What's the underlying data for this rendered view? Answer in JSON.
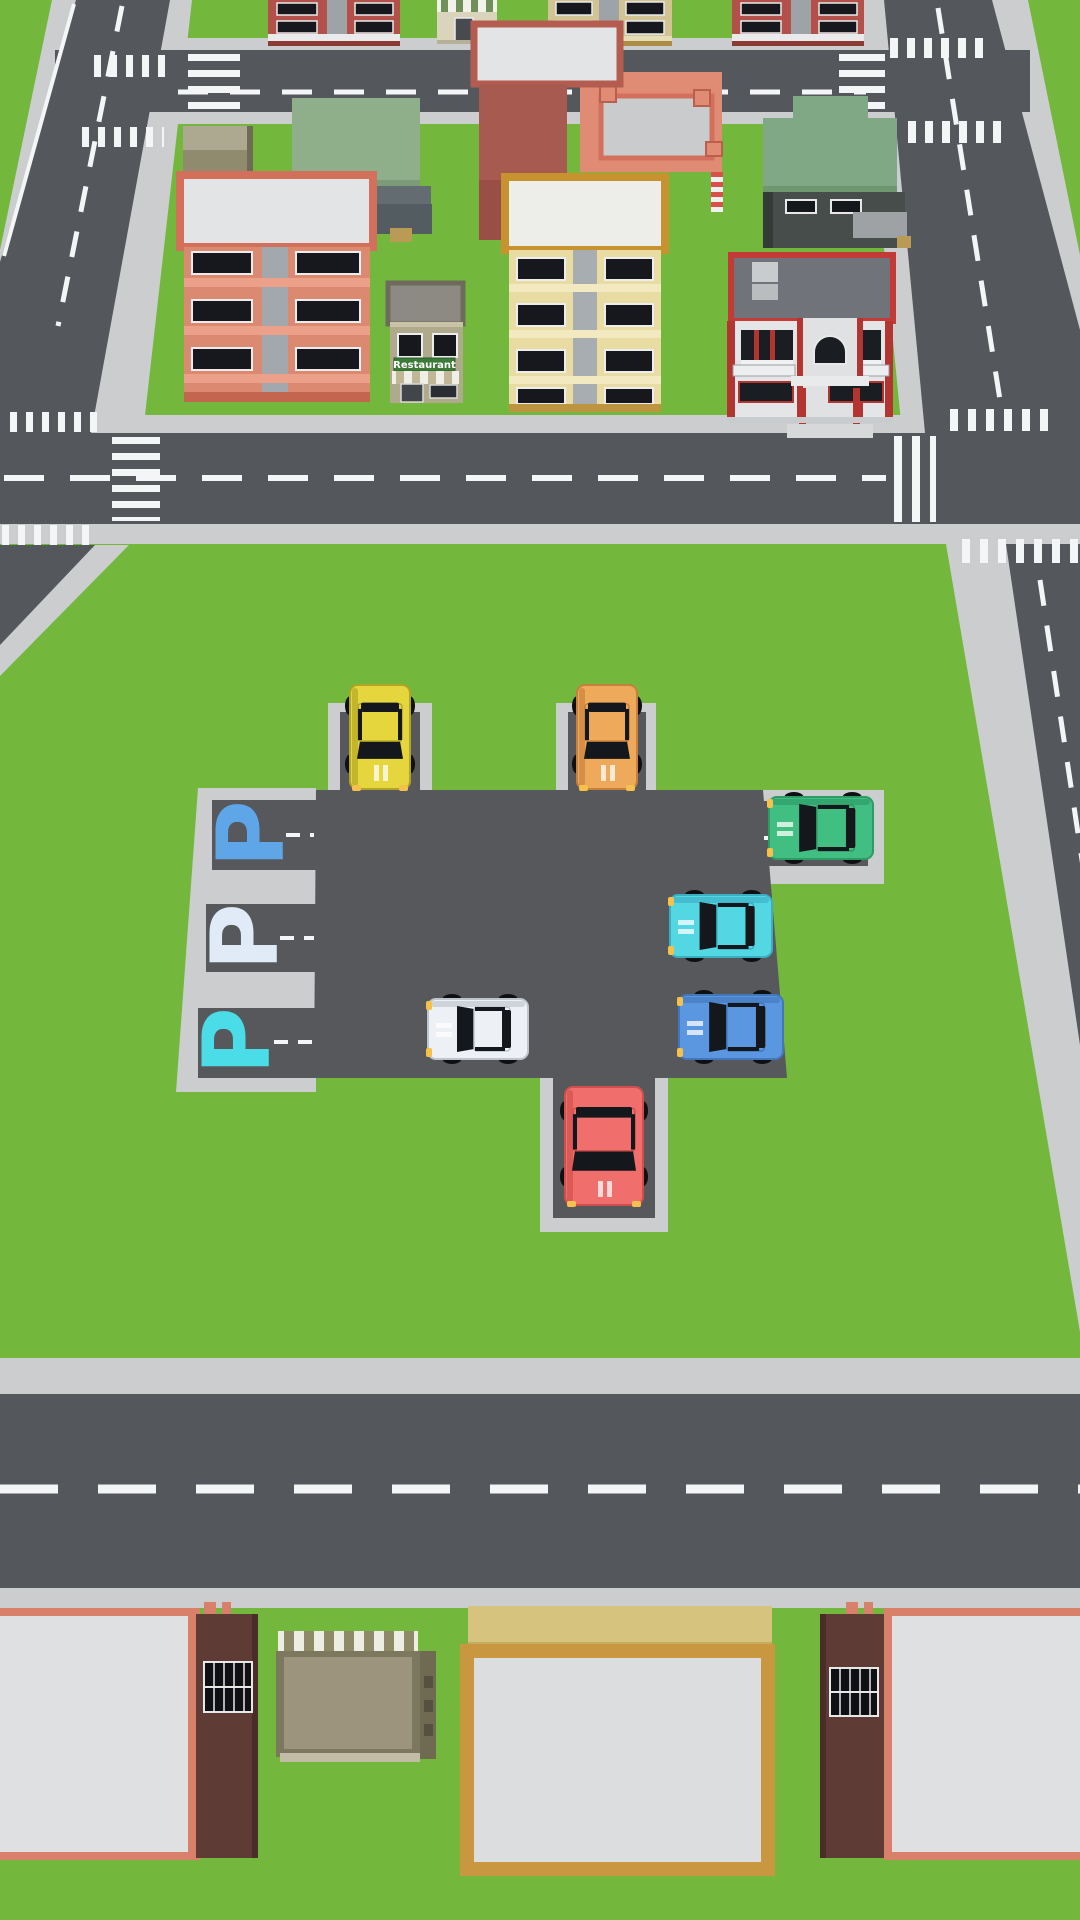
{
  "scene": {
    "name": "parking-jam-city-level",
    "palette": {
      "grass": "#73B73D",
      "road": "#54575B",
      "sidewalk": "#CBCDCE",
      "lot": "#56585C",
      "line": "#F4F5F6",
      "glass": "#14171C",
      "headlight": "#F6C14A"
    },
    "labels": {
      "restaurant_sign": "Restaurant"
    },
    "parking": {
      "markers": [
        {
          "label": "P",
          "color": "#5FA6E8",
          "x": 250,
          "y": 834
        },
        {
          "label": "P",
          "color": "#E0EBF7",
          "x": 244,
          "y": 937
        },
        {
          "label": "P",
          "color": "#4ADDE7",
          "x": 236,
          "y": 1041
        }
      ],
      "slots": [
        {
          "id": "slot-top-1",
          "status": "occupied",
          "car": "car-yellow"
        },
        {
          "id": "slot-top-2",
          "status": "occupied",
          "car": "car-orange"
        },
        {
          "id": "slot-right",
          "status": "occupied",
          "car": "car-green"
        },
        {
          "id": "slot-bottom",
          "status": "occupied",
          "car": "car-red"
        },
        {
          "id": "slot-left-1",
          "status": "empty",
          "marker_color": "#5FA6E8"
        },
        {
          "id": "slot-left-2",
          "status": "empty",
          "marker_color": "#E0EBF7"
        },
        {
          "id": "slot-left-3",
          "status": "empty",
          "marker_color": "#4ADDE7"
        }
      ]
    },
    "cars": [
      {
        "id": "car-yellow",
        "color": "#E4D63C",
        "shade": "#B0A524",
        "x": 380,
        "y": 737,
        "angle": 180,
        "len": 104,
        "wid": 60
      },
      {
        "id": "car-orange",
        "color": "#EFA95B",
        "shade": "#C4803C",
        "x": 607,
        "y": 737,
        "angle": 180,
        "len": 104,
        "wid": 60
      },
      {
        "id": "car-green",
        "color": "#41BE81",
        "shade": "#2E9A65",
        "x": 821,
        "y": 828,
        "angle": 270,
        "len": 104,
        "wid": 62
      },
      {
        "id": "car-cyan",
        "color": "#53D7E3",
        "shade": "#3AAFC4",
        "x": 721,
        "y": 926,
        "angle": 270,
        "len": 102,
        "wid": 62
      },
      {
        "id": "car-white",
        "color": "#EDF0F4",
        "shade": "#BFC5CF",
        "x": 478,
        "y": 1029,
        "angle": 270,
        "len": 100,
        "wid": 60
      },
      {
        "id": "car-blue",
        "color": "#5A97E0",
        "shade": "#4278BB",
        "x": 731,
        "y": 1027,
        "angle": 270,
        "len": 104,
        "wid": 64
      },
      {
        "id": "car-red",
        "color": "#F06F6C",
        "shade": "#CE4F4C",
        "x": 604,
        "y": 1146,
        "angle": 180,
        "len": 118,
        "wid": 78
      }
    ]
  }
}
